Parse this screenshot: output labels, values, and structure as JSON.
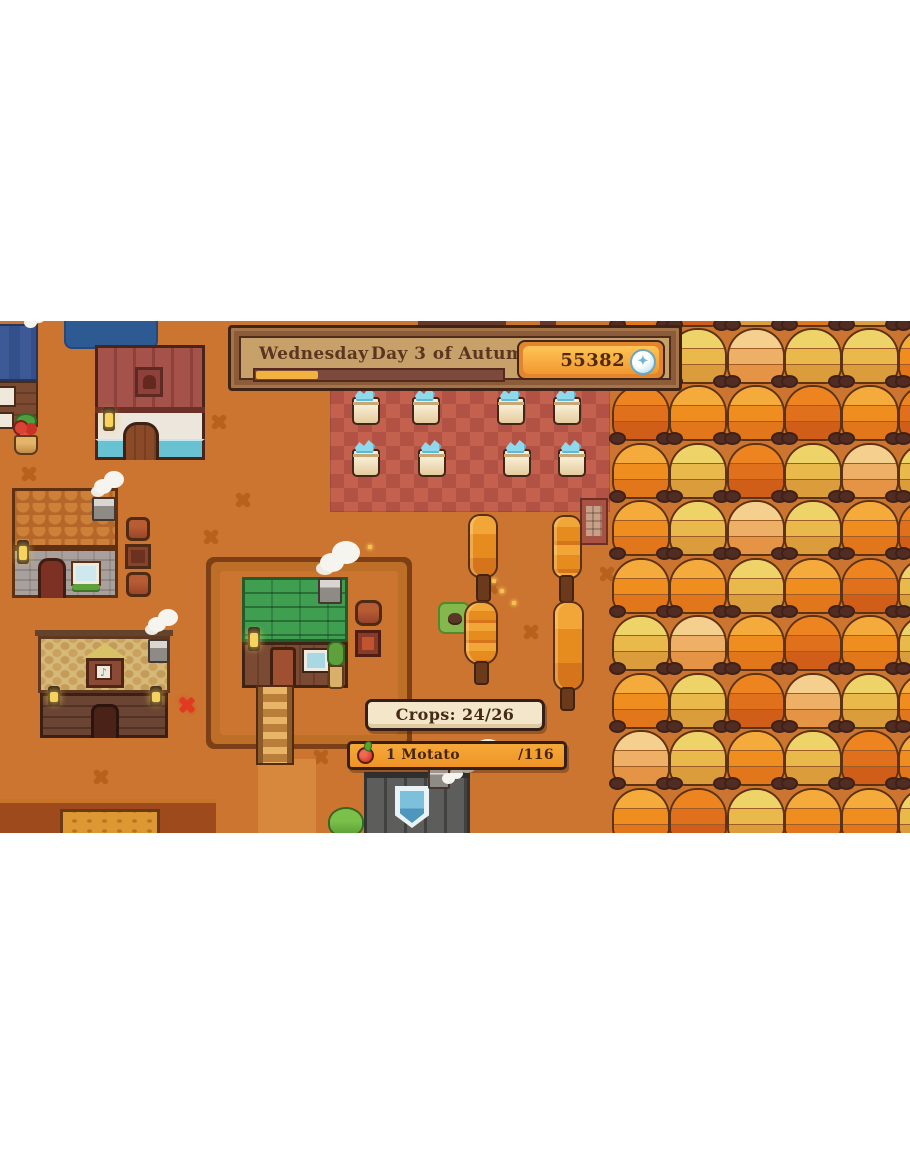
{
  "hud": {
    "date_banner": {
      "weekday": "Wednesday",
      "day_label": "Day 3 of Autumn",
      "progress_pct": 25,
      "money": "55382",
      "coin_icon": "coin-sparkle"
    },
    "crops_tooltip": {
      "label": "Crops: 24/26"
    },
    "harvest_bar": {
      "icon": "motato-fruit",
      "item_count": "1 Motato",
      "capacity": "/116"
    }
  },
  "scene": {
    "orchard": {
      "palette": {
        "o": [
          "#f5ab3c",
          "#ef8d1f",
          "#e2761a"
        ],
        "g": [
          "#eed468",
          "#e9b94b",
          "#db9c3c"
        ],
        "d": [
          "#ee8420",
          "#e0701c",
          "#d05e18"
        ],
        "p": [
          "#f4cf8e",
          "#eeb066",
          "#e59344"
        ]
      },
      "rows": [
        "odgogd",
        "ogpggo",
        "doodod",
        "ogdgpg",
        "ogpgod",
        "oogodg",
        "gpodog",
        "ogdpgo",
        "pgogdo",
        "odgoog"
      ]
    },
    "colors": {
      "ground": "#cc7530",
      "ground_decal": "#b7611f",
      "market_tile_a": "#c4604e",
      "market_tile_b": "#b25244",
      "banner_panel": "#c8a16a",
      "money_pill": "#f7a93c",
      "pond": "#2e5a94"
    }
  }
}
